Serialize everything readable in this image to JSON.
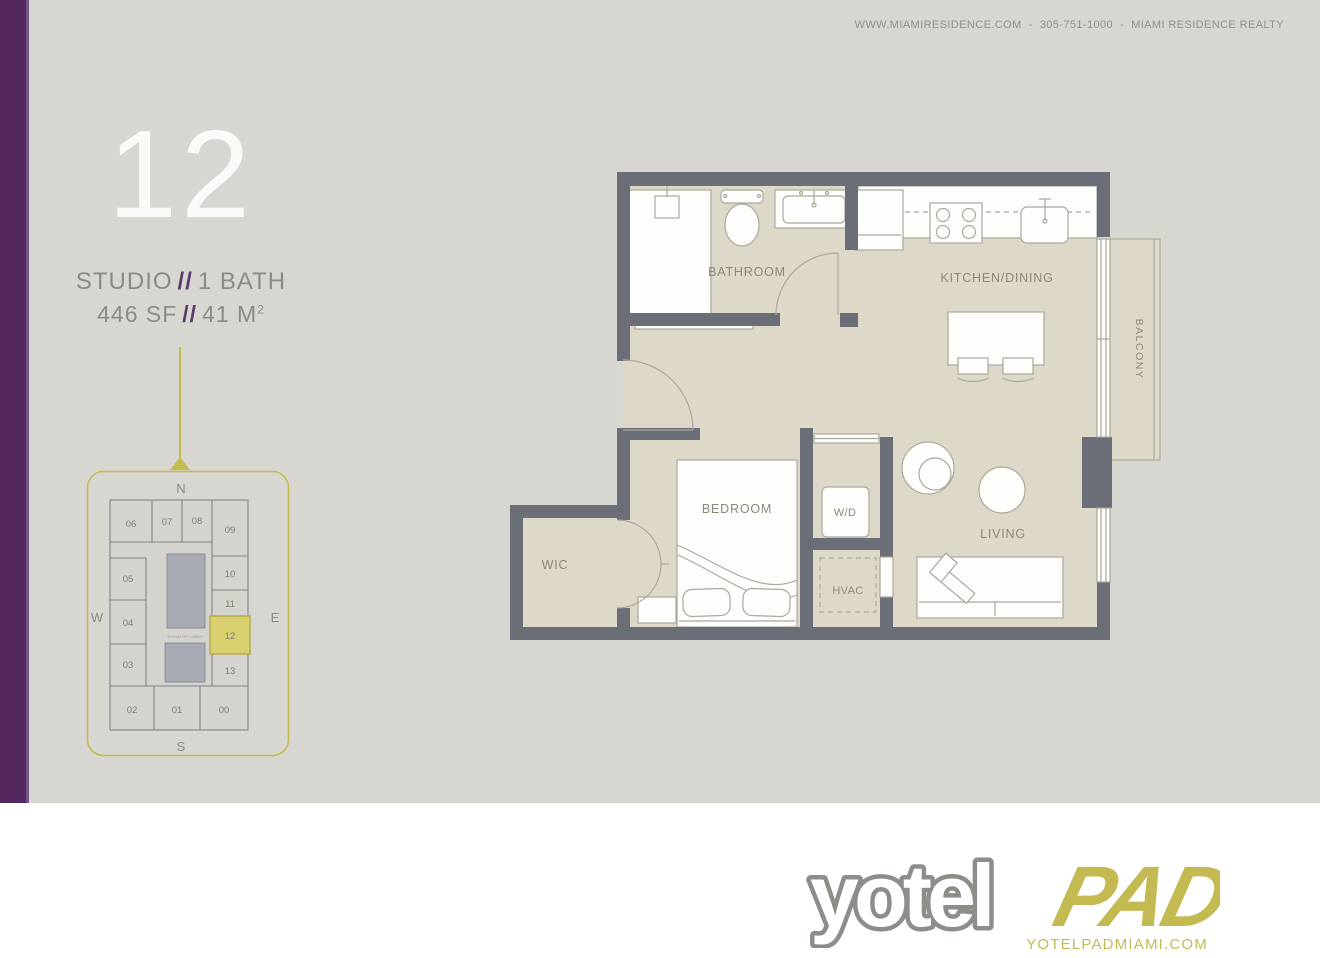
{
  "header": {
    "website": "WWW.MIAMIRESIDENCE.COM",
    "phone": "305-751-1000",
    "company": "MIAMI RESIDENCE REALTY",
    "separator": "-"
  },
  "unit": {
    "number": "12",
    "type": "STUDIO",
    "slashes": "//",
    "baths": "1 BATH",
    "area_sf": "446 SF",
    "area_m": "41 M",
    "area_m_sup": "2"
  },
  "floorplan": {
    "rooms": {
      "bathroom": "BATHROOM",
      "kitchen": "KITCHEN/DINING",
      "balcony": "BALCONY",
      "bedroom": "BEDROOM",
      "wic": "WIC",
      "wd": "W/D",
      "hvac": "HVAC",
      "living": "LIVING"
    }
  },
  "keyplan": {
    "compass": {
      "n": "N",
      "s": "S",
      "e": "E",
      "w": "W"
    },
    "elevator_label": "ELEVATOR LOBBY",
    "highlighted_unit": "12",
    "units": [
      {
        "label": "06",
        "highlighted": false
      },
      {
        "label": "07",
        "highlighted": false
      },
      {
        "label": "08",
        "highlighted": false
      },
      {
        "label": "09",
        "highlighted": false
      },
      {
        "label": "05",
        "highlighted": false
      },
      {
        "label": "04",
        "highlighted": false
      },
      {
        "label": "03",
        "highlighted": false
      },
      {
        "label": "10",
        "highlighted": false
      },
      {
        "label": "11",
        "highlighted": false
      },
      {
        "label": "12",
        "highlighted": true
      },
      {
        "label": "13",
        "highlighted": false
      },
      {
        "label": "02",
        "highlighted": false
      },
      {
        "label": "01",
        "highlighted": false
      },
      {
        "label": "00",
        "highlighted": false
      }
    ]
  },
  "footer": {
    "logo_yotel": "yotel",
    "logo_pad": "PAD",
    "website": "YOTELPADMIAMI.COM"
  },
  "colors": {
    "panel-bg": "#d7d6d1",
    "purple": "#52285f",
    "purple-edge": "#745189",
    "olive": "#c2bb4f",
    "olive-fill": "#d8d06e",
    "wall": "#6a6e77",
    "floor": "#ddd8c7",
    "fixture": "#fdfdfb",
    "outline": "#a9a99c",
    "label": "#8c8977",
    "muted-text": "#90908c",
    "unit-text": "#8b8b86",
    "slash-purple": "#5b3b6d",
    "logo-gray": "#8e8d89",
    "logo-olive": "#c3ba52",
    "white": "#fbfaf8",
    "keyplan-wall": "#7f838c",
    "keyplan-floor": "#d5d3cd",
    "keyplan-elev": "#a7abb3",
    "keyplan-num": "#7c7c75"
  }
}
